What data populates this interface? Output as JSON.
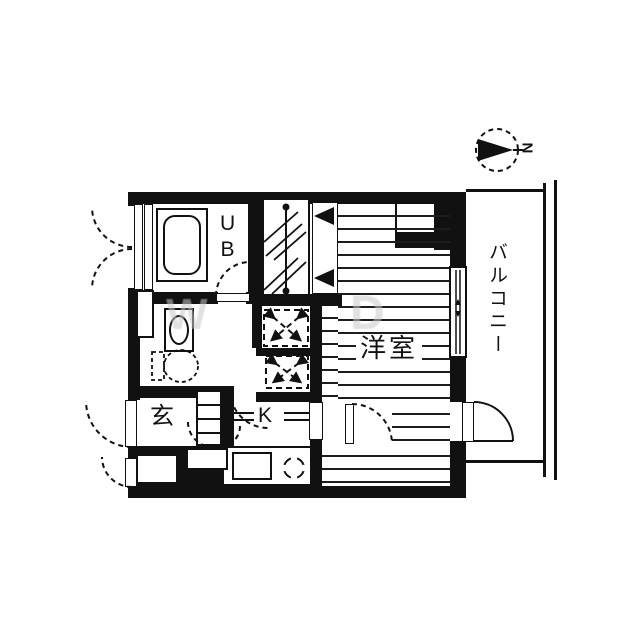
{
  "floorplan": {
    "labels": {
      "unit_bath": "UB",
      "entrance": "玄",
      "kitchen": "K",
      "western_room": "洋室",
      "balcony": "バルコニー"
    },
    "compass": {
      "north": "N"
    },
    "watermark": {
      "glyph_1": "W",
      "glyph_2": "D"
    },
    "colors": {
      "wall": "#111111",
      "floor_line": "#1d1d1d",
      "background": "#ffffff",
      "watermark": "#c9c9c9"
    }
  }
}
